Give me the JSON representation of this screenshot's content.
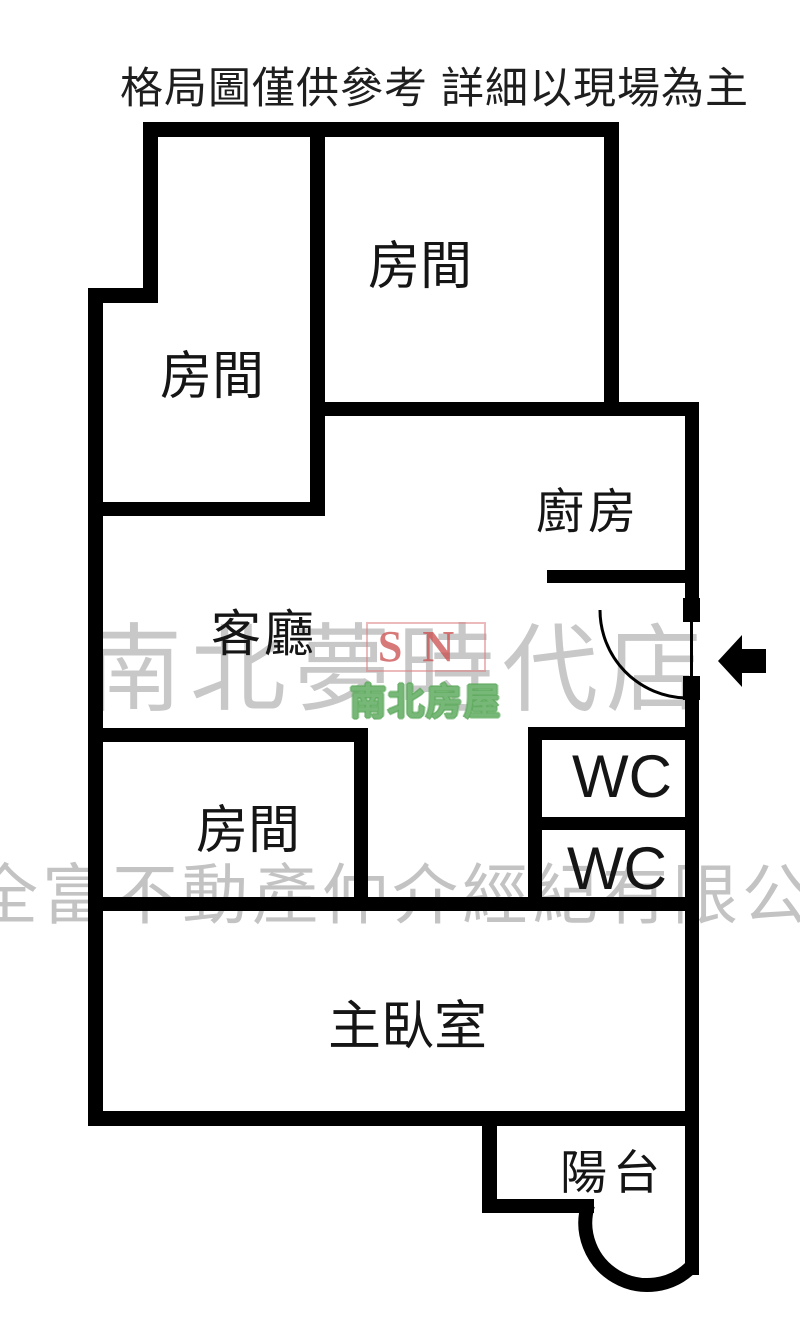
{
  "title": "格局圖僅供參考 詳細以現場為主",
  "rooms": {
    "top_left": "房間",
    "top_right": "房間",
    "kitchen": "廚房",
    "living": "客廳",
    "mid_left": "房間",
    "wc_upper": "WC",
    "wc_lower": "WC",
    "master": "主臥室",
    "balcony": "陽台"
  },
  "watermark": {
    "brand_row": "南北夢時代店",
    "logo_initials": "SN",
    "logo_name": "南北房屋",
    "company_row": "全富不動產仲介經紀有限公"
  },
  "colors": {
    "wall": "#000000",
    "watermark_gray": "#bdbdbd",
    "logo_red": "#c94c4c",
    "logo_green": "#5faa5f"
  }
}
